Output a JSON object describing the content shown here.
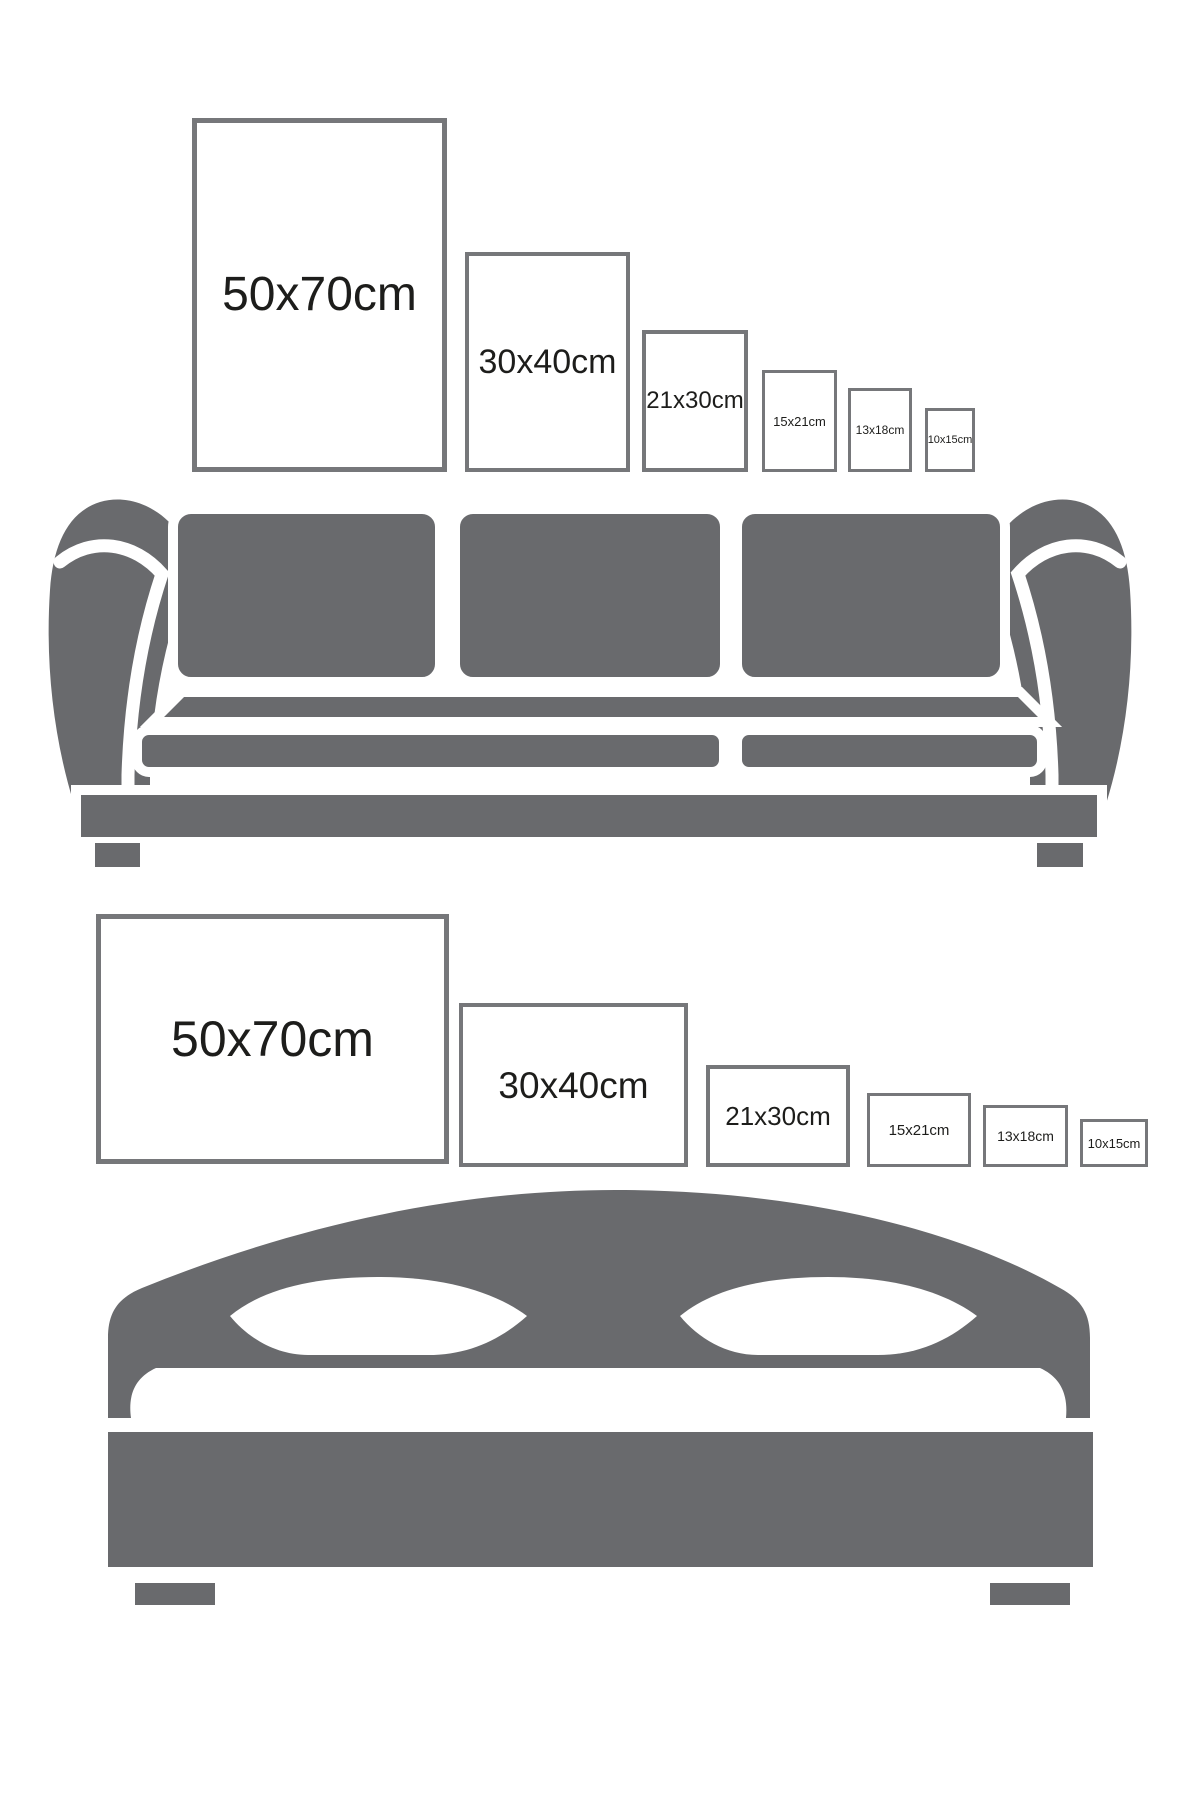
{
  "title": "poster frame size guide",
  "colors": {
    "illustration_gray": "#696a6d",
    "frame_border_gray": "#76777a",
    "label_text": "#1d1d1b",
    "background": "#ffffff"
  },
  "portrait_row": {
    "orientation": "portrait",
    "frames": [
      {
        "label": "50x70cm"
      },
      {
        "label": "30x40cm"
      },
      {
        "label": "21x30cm"
      },
      {
        "label": "15x21cm"
      },
      {
        "label": "13x18cm"
      },
      {
        "label": "10x15cm"
      }
    ]
  },
  "landscape_row": {
    "orientation": "landscape",
    "frames": [
      {
        "label": "50x70cm"
      },
      {
        "label": "30x40cm"
      },
      {
        "label": "21x30cm"
      },
      {
        "label": "15x21cm"
      },
      {
        "label": "13x18cm"
      },
      {
        "label": "10x15cm"
      }
    ]
  },
  "icons": [
    {
      "name": "sofa-icon",
      "description": "three-seat sofa silhouette"
    },
    {
      "name": "bed-icon",
      "description": "double bed with arched headboard silhouette"
    }
  ]
}
